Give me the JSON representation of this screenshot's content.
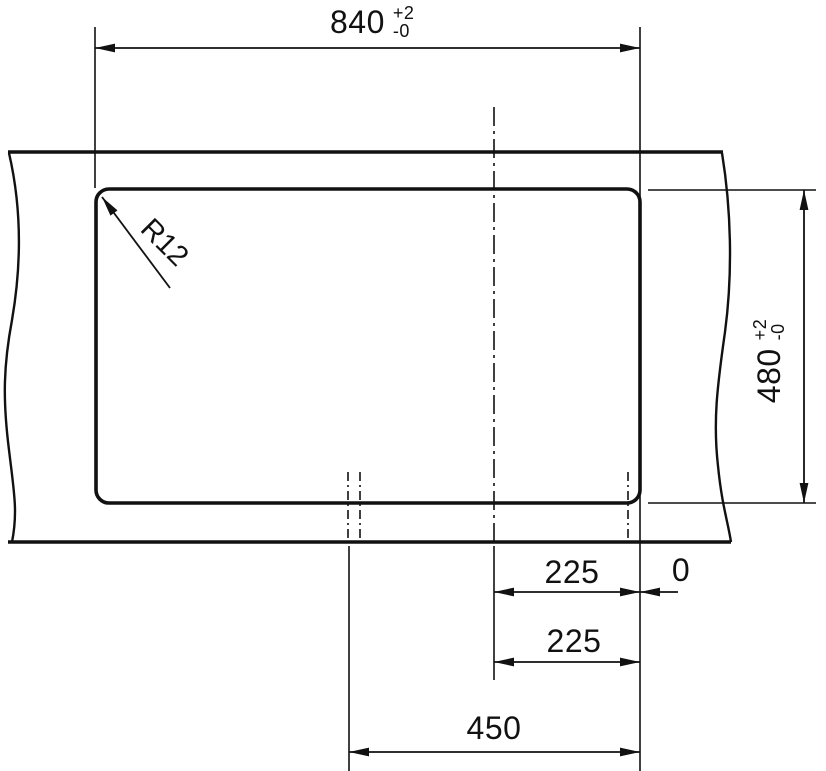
{
  "drawing": {
    "kind": "worktop-cutout-dimension-drawing",
    "labels": {
      "width": {
        "value": "840",
        "tol_plus": "+2",
        "tol_minus": "-0"
      },
      "height": {
        "value": "480",
        "tol_plus": "+2",
        "tol_minus": "-0"
      },
      "corner_radius": "R12",
      "center_to_edge_upper": "225",
      "center_to_edge_lower": "225",
      "zero_reference": "0",
      "half_width": "450"
    },
    "colors": {
      "line": "#111111",
      "background": "#ffffff"
    }
  }
}
